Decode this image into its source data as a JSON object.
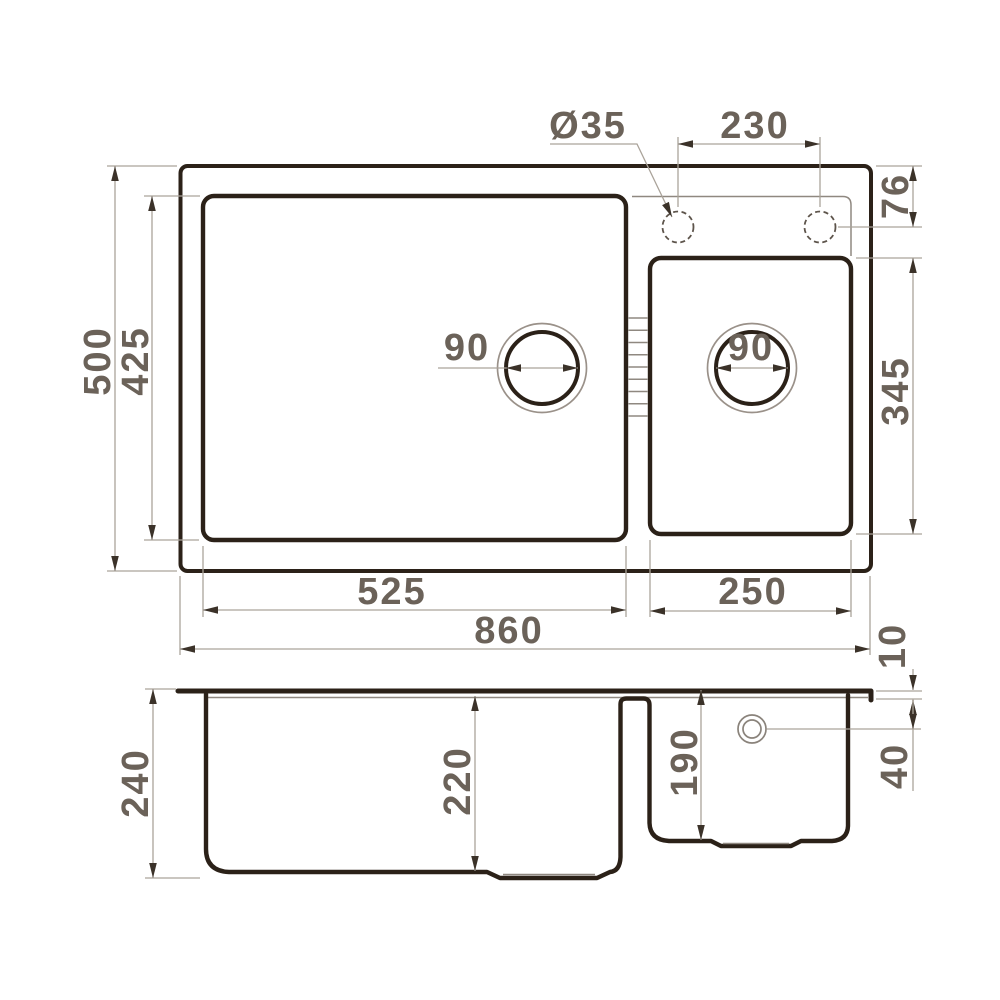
{
  "drawing": {
    "title": "Double-bowl kitchen sink dimension drawing",
    "colors": {
      "background": "#ffffff",
      "outline_ink": "#2b2118",
      "thin_line": "#8f8880",
      "dimension_line": "#aaa39a",
      "arrow": "#3b3229",
      "label_text": "#6b6259"
    },
    "top_view": {
      "overall_width": "860",
      "overall_depth": "500",
      "main_bowl": {
        "width": "525",
        "depth": "425",
        "drain_diameter": "90"
      },
      "small_bowl": {
        "width": "250",
        "depth": "345",
        "drain_diameter": "90"
      },
      "faucet": {
        "hole_diameter": "Ø35",
        "hole_spacing": "230",
        "offset_from_edge": "76"
      }
    },
    "section_view": {
      "total_height": "240",
      "main_bowl_depth": "220",
      "small_bowl_depth": "190",
      "overflow_offset_from_top": "40",
      "rim_thickness": "10"
    }
  }
}
